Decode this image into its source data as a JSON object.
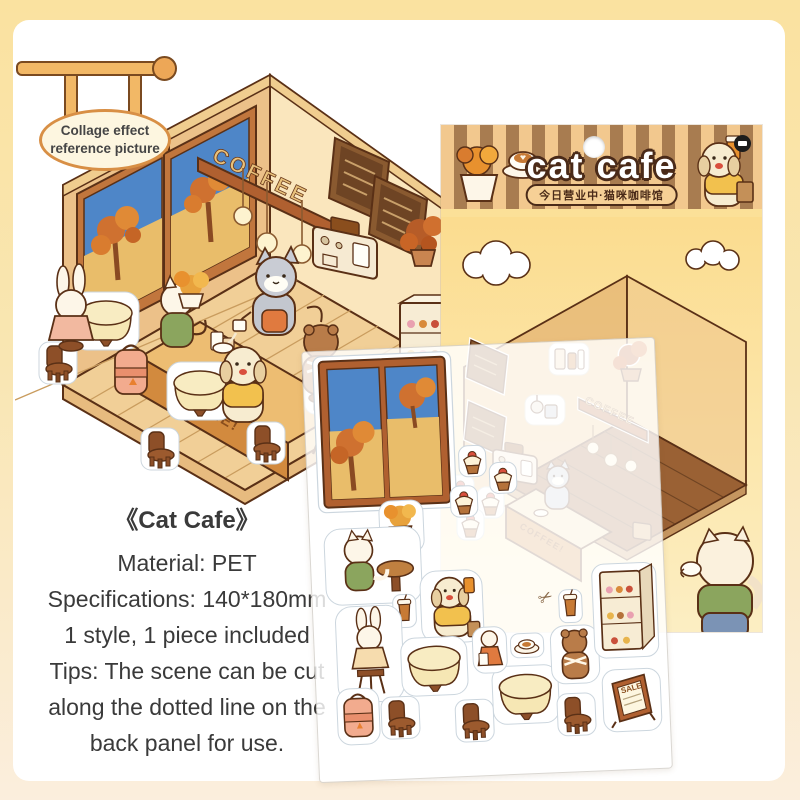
{
  "sign": {
    "line1": "Collage effect",
    "line2": "reference picture"
  },
  "package": {
    "title": "cat cafe",
    "subtitle": "今日营业中·猫咪咖啡馆",
    "coffee_sign": "COFFEE",
    "counter_label": "COFFEE!",
    "stripe_tan": "#f2c88e",
    "stripe_brown": "#a87c50"
  },
  "illustration": {
    "coffee_sign": "COFFEE",
    "counter_label": "COFFEE!",
    "sale_label": "SALE"
  },
  "sticker_sheet": {
    "sale_label": "SALE",
    "scissors_icon": "✂"
  },
  "description": {
    "title": "《Cat Cafe》",
    "lines": [
      "Material: PET",
      "Specifications: 140*180mm",
      "1 style, 1 piece included",
      "Tips: The scene can be cut",
      "along the dotted line on the",
      "back panel for use."
    ]
  }
}
